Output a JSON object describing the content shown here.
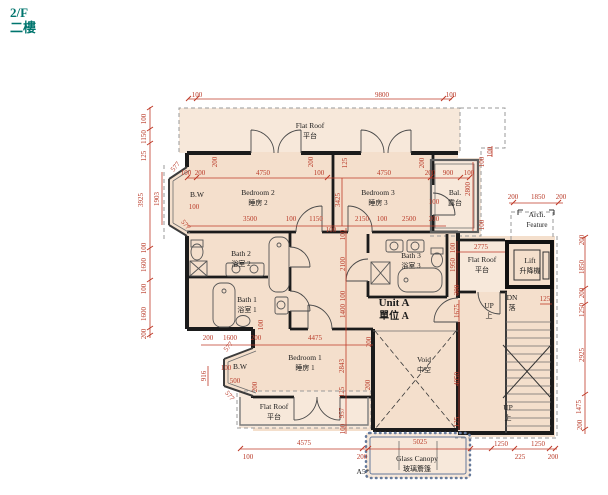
{
  "title": {
    "line1": "2/F",
    "line2": "二樓",
    "color": "#00756e"
  },
  "plan": {
    "colors": {
      "room_fill": "#f4dfcc",
      "outdoor_fill": "#f7e8da",
      "wall": "#1b1b1b",
      "dimension": "#bf3a28",
      "canopy": "#64799b",
      "title": "#00756e"
    },
    "labels": [
      {
        "n": "flat-roof-top",
        "l1": "Flat Roof",
        "l2": "平台",
        "x": 310,
        "y": 128
      },
      {
        "n": "bedroom-2",
        "l1": "Bedroom 2",
        "l2": "睡房 2",
        "x": 258,
        "y": 195
      },
      {
        "n": "bedroom-3",
        "l1": "Bedroom 3",
        "l2": "睡房 3",
        "x": 378,
        "y": 195
      },
      {
        "n": "balcony",
        "l1": "Bal.",
        "l2": "露台",
        "x": 455,
        "y": 195,
        "fs": 6.5
      },
      {
        "n": "arch-feature",
        "l1": "Arch.",
        "l2": "Feature",
        "x": 537,
        "y": 217,
        "fs": 6.5
      },
      {
        "n": "lift",
        "l1": "Lift",
        "l2": "升降機",
        "x": 530,
        "y": 263,
        "fs": 7
      },
      {
        "n": "flat-roof-lift",
        "l1": "Flat Roof",
        "l2": "平台",
        "x": 482,
        "y": 262,
        "fs": 7
      },
      {
        "n": "bath-3",
        "l1": "Bath 3",
        "l2": "浴室 3",
        "x": 411,
        "y": 258,
        "fs": 7
      },
      {
        "n": "bath-2",
        "l1": "Bath 2",
        "l2": "浴室 2",
        "x": 241,
        "y": 256,
        "fs": 7
      },
      {
        "n": "bath-1",
        "l1": "Bath 1",
        "l2": "浴室 1",
        "x": 247,
        "y": 302,
        "fs": 7
      },
      {
        "n": "unit-a",
        "l1": "Unit A",
        "l2": "單位 A",
        "x": 394,
        "y": 306,
        "big": true
      },
      {
        "n": "bedroom-1",
        "l1": "Bedroom 1",
        "l2": "睡房 1",
        "x": 305,
        "y": 360
      },
      {
        "n": "flat-roof-bottom",
        "l1": "Flat Roof",
        "l2": "平台",
        "x": 274,
        "y": 409,
        "fs": 7
      },
      {
        "n": "void",
        "l1": "Void",
        "l2": "中空",
        "x": 424,
        "y": 362,
        "fs": 7
      },
      {
        "n": "glass-canopy",
        "l1": "Glass Canopy",
        "l2": "玻璃簷篷",
        "x": 417,
        "y": 461,
        "fs": 7
      },
      {
        "n": "bay-window-upper",
        "l1": "B.W",
        "x": 197,
        "y": 197,
        "fs": 6
      },
      {
        "n": "bay-window-lower",
        "l1": "B.W",
        "x": 240,
        "y": 369,
        "fs": 6
      },
      {
        "n": "up-upper",
        "l1": "UP",
        "l2": "上",
        "x": 489,
        "y": 308,
        "fs": 6
      },
      {
        "n": "dn-upper",
        "l1": "DN",
        "l2": "落",
        "x": 512,
        "y": 300,
        "fs": 6
      },
      {
        "n": "up-lower",
        "l1": "UP",
        "l2": "上",
        "x": 508,
        "y": 410,
        "fs": 6
      },
      {
        "n": "note-a5",
        "l1": "A5*",
        "x": 363,
        "y": 474,
        "fs": 7
      }
    ],
    "dims": [
      {
        "t": "100",
        "x": 197,
        "y": 97
      },
      {
        "t": "9800",
        "x": 382,
        "y": 97
      },
      {
        "t": "100",
        "x": 451,
        "y": 97
      },
      {
        "t": "100",
        "x": 146,
        "y": 119,
        "r": -90
      },
      {
        "t": "1150",
        "x": 146,
        "y": 137,
        "r": -90
      },
      {
        "t": "125",
        "x": 146,
        "y": 156,
        "r": -90
      },
      {
        "t": "3925",
        "x": 143,
        "y": 200,
        "r": -90
      },
      {
        "t": "1903",
        "x": 159,
        "y": 199,
        "r": -90
      },
      {
        "t": "100",
        "x": 146,
        "y": 248,
        "r": -90
      },
      {
        "t": "1600",
        "x": 146,
        "y": 265,
        "r": -90
      },
      {
        "t": "100",
        "x": 146,
        "y": 289,
        "r": -90
      },
      {
        "t": "1600",
        "x": 146,
        "y": 314,
        "r": -90
      },
      {
        "t": "200",
        "x": 146,
        "y": 334,
        "r": -90
      },
      {
        "t": "577",
        "x": 177,
        "y": 168,
        "r": -50
      },
      {
        "t": "577",
        "x": 184,
        "y": 226,
        "r": 50
      },
      {
        "t": "200",
        "x": 217,
        "y": 162,
        "r": -90
      },
      {
        "t": "200",
        "x": 313,
        "y": 162,
        "r": -90
      },
      {
        "t": "125",
        "x": 347,
        "y": 163,
        "r": -90
      },
      {
        "t": "200",
        "x": 424,
        "y": 163,
        "r": -90
      },
      {
        "t": "100",
        "x": 186,
        "y": 175
      },
      {
        "t": "200",
        "x": 200,
        "y": 175
      },
      {
        "t": "4750",
        "x": 263,
        "y": 175
      },
      {
        "t": "100",
        "x": 319,
        "y": 175
      },
      {
        "t": "4750",
        "x": 384,
        "y": 175
      },
      {
        "t": "200",
        "x": 430,
        "y": 175
      },
      {
        "t": "900",
        "x": 448,
        "y": 175
      },
      {
        "t": "100",
        "x": 469,
        "y": 175
      },
      {
        "t": "100",
        "x": 194,
        "y": 209
      },
      {
        "t": "3425",
        "x": 340,
        "y": 200,
        "r": -90
      },
      {
        "t": "100",
        "x": 434,
        "y": 204
      },
      {
        "t": "2800",
        "x": 470,
        "y": 189,
        "r": -90
      },
      {
        "t": "100",
        "x": 484,
        "y": 162,
        "r": -90
      },
      {
        "t": "100",
        "x": 484,
        "y": 225,
        "r": -90
      },
      {
        "t": "100",
        "x": 492,
        "y": 152,
        "r": -90
      },
      {
        "t": "3500",
        "x": 250,
        "y": 221
      },
      {
        "t": "100",
        "x": 291,
        "y": 221
      },
      {
        "t": "1150",
        "x": 316,
        "y": 221
      },
      {
        "t": "100",
        "x": 331,
        "y": 232
      },
      {
        "t": "2150",
        "x": 362,
        "y": 221
      },
      {
        "t": "100",
        "x": 382,
        "y": 221
      },
      {
        "t": "2500",
        "x": 409,
        "y": 221
      },
      {
        "t": "200",
        "x": 434,
        "y": 221
      },
      {
        "t": "200",
        "x": 513,
        "y": 199
      },
      {
        "t": "1850",
        "x": 538,
        "y": 199
      },
      {
        "t": "200",
        "x": 561,
        "y": 199
      },
      {
        "t": "200",
        "x": 584,
        "y": 240,
        "r": -90
      },
      {
        "t": "1850",
        "x": 584,
        "y": 267,
        "r": -90
      },
      {
        "t": "200",
        "x": 584,
        "y": 293,
        "r": -90
      },
      {
        "t": "1250",
        "x": 584,
        "y": 310,
        "r": -90
      },
      {
        "t": "2925",
        "x": 584,
        "y": 355,
        "r": -90
      },
      {
        "t": "1475",
        "x": 581,
        "y": 407,
        "r": -90
      },
      {
        "t": "200",
        "x": 582,
        "y": 425,
        "r": -90
      },
      {
        "t": "125",
        "x": 545,
        "y": 301
      },
      {
        "t": "2775",
        "x": 481,
        "y": 249
      },
      {
        "t": "100",
        "x": 455,
        "y": 248,
        "r": -90
      },
      {
        "t": "1950",
        "x": 455,
        "y": 265,
        "r": -90
      },
      {
        "t": "300",
        "x": 459,
        "y": 290,
        "r": -90
      },
      {
        "t": "100",
        "x": 345,
        "y": 235,
        "r": -90
      },
      {
        "t": "2100",
        "x": 345,
        "y": 264,
        "r": -90
      },
      {
        "t": "100",
        "x": 345,
        "y": 296,
        "r": -90
      },
      {
        "t": "1400",
        "x": 345,
        "y": 311,
        "r": -90
      },
      {
        "t": "2843",
        "x": 344,
        "y": 366,
        "r": -90
      },
      {
        "t": "125",
        "x": 344,
        "y": 392,
        "r": -90
      },
      {
        "t": "957",
        "x": 344,
        "y": 413,
        "r": -90
      },
      {
        "t": "100",
        "x": 345,
        "y": 429,
        "r": -90
      },
      {
        "t": "1675",
        "x": 459,
        "y": 311,
        "r": -90
      },
      {
        "t": "4050",
        "x": 459,
        "y": 379,
        "r": -90
      },
      {
        "t": "125",
        "x": 459,
        "y": 422,
        "r": -90
      },
      {
        "t": "200",
        "x": 371,
        "y": 342,
        "r": -90
      },
      {
        "t": "200",
        "x": 370,
        "y": 385,
        "r": -90
      },
      {
        "t": "200",
        "x": 208,
        "y": 340
      },
      {
        "t": "1600",
        "x": 230,
        "y": 340
      },
      {
        "t": "200",
        "x": 256,
        "y": 340
      },
      {
        "t": "4475",
        "x": 315,
        "y": 340
      },
      {
        "t": "100",
        "x": 263,
        "y": 325,
        "r": -90
      },
      {
        "t": "916",
        "x": 206,
        "y": 376,
        "r": -90
      },
      {
        "t": "100",
        "x": 226,
        "y": 370
      },
      {
        "t": "500",
        "x": 235,
        "y": 383
      },
      {
        "t": "577",
        "x": 230,
        "y": 348,
        "r": -50
      },
      {
        "t": "577",
        "x": 228,
        "y": 397,
        "r": 50
      },
      {
        "t": "200",
        "x": 257,
        "y": 387,
        "r": -90
      },
      {
        "t": "4575",
        "x": 304,
        "y": 445
      },
      {
        "t": "100",
        "x": 248,
        "y": 459
      },
      {
        "t": "200",
        "x": 362,
        "y": 459
      },
      {
        "t": "5025",
        "x": 420,
        "y": 444
      },
      {
        "t": "1250",
        "x": 501,
        "y": 446
      },
      {
        "t": "1250",
        "x": 538,
        "y": 446
      },
      {
        "t": "225",
        "x": 520,
        "y": 459
      },
      {
        "t": "200",
        "x": 553,
        "y": 459
      }
    ]
  }
}
